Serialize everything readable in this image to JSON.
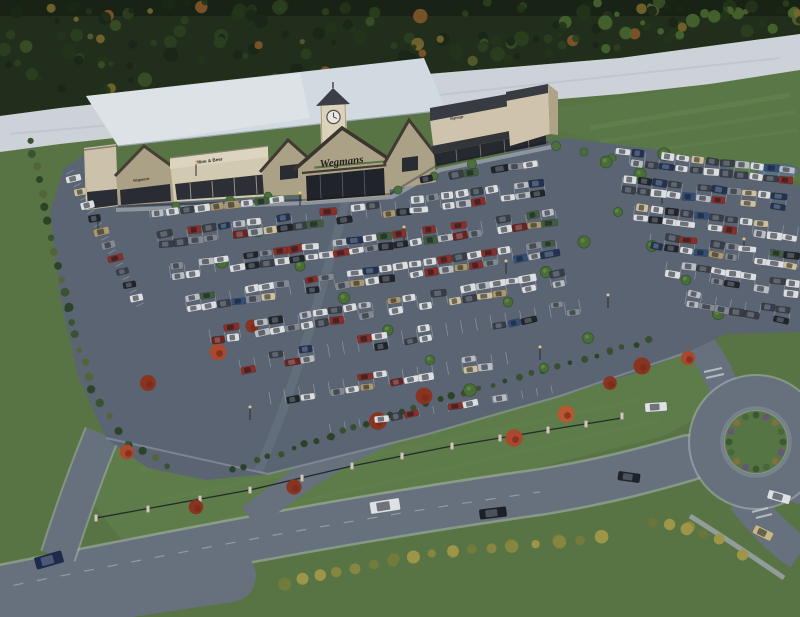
{
  "scene": {
    "description": "Aerial dusk rendering of a Wegmans supermarket with clock tower, large parking lot full of cars, landscaped entrance drive and roundabout",
    "width": 800,
    "height": 617
  },
  "signs": {
    "main": "Wegmans",
    "left_gable": "Wegmans",
    "wine_beer": "Wine & Beer",
    "right_wing": "Signage"
  },
  "palette": {
    "grass": "#5c7946",
    "lawn": "#63814b",
    "forest": "#232f1b",
    "strip": "#d6dce1",
    "field": "#5e7d48",
    "asphalt": "#5f6876",
    "road": "#6c7582",
    "stone": "#b4a88c",
    "cream": "#dacdb2",
    "roof": "#dde4ea",
    "pond": "#5e7886",
    "dark_storefront": "#272a2f",
    "sign_band_dark": "#3a3d42"
  },
  "forest": {
    "count": 170,
    "seed": 11,
    "colors": [
      [
        "#1b2817",
        28
      ],
      [
        "#233519",
        24
      ],
      [
        "#2d431f",
        20
      ],
      [
        "#3c5226",
        10
      ],
      [
        "#5c6030",
        8
      ],
      [
        "#7c6a2e",
        5
      ],
      [
        "#8a5a28",
        5
      ]
    ]
  },
  "parking": {
    "seed": 7,
    "spacing": 15,
    "car_w": 13,
    "car_h": 6.6,
    "car_colors": [
      [
        "#e7e9eb",
        30
      ],
      [
        "#c2c6cc",
        14
      ],
      [
        "#8a8f97",
        10
      ],
      [
        "#3a3f47",
        16
      ],
      [
        "#22252a",
        8
      ],
      [
        "#8e3027",
        6
      ],
      [
        "#6e241f",
        3
      ],
      [
        "#35517c",
        5
      ],
      [
        "#243352",
        4
      ],
      [
        "#b3a071",
        5
      ],
      [
        "#44603f",
        3
      ],
      [
        "#d8c9a3",
        3
      ]
    ],
    "rows": [
      {
        "x1": 150,
        "y1": 214,
        "x2": 292,
        "y2": 198,
        "fill": 0.9,
        "double": false
      },
      {
        "x1": 404,
        "y1": 182,
        "x2": 548,
        "y2": 162,
        "fill": 0.85,
        "double": false
      },
      {
        "x1": 158,
        "y1": 240,
        "x2": 556,
        "y2": 186,
        "fill": 0.8,
        "double": true
      },
      {
        "x1": 170,
        "y1": 272,
        "x2": 562,
        "y2": 216,
        "fill": 0.8,
        "double": true
      },
      {
        "x1": 186,
        "y1": 304,
        "x2": 568,
        "y2": 246,
        "fill": 0.75,
        "double": true
      },
      {
        "x1": 210,
        "y1": 336,
        "x2": 575,
        "y2": 276,
        "fill": 0.65,
        "double": true
      },
      {
        "x1": 240,
        "y1": 366,
        "x2": 580,
        "y2": 306,
        "fill": 0.35,
        "double": true
      },
      {
        "x1": 270,
        "y1": 398,
        "x2": 520,
        "y2": 356,
        "fill": 0.3,
        "double": true
      },
      {
        "x1": 330,
        "y1": 428,
        "x2": 560,
        "y2": 388,
        "fill": 0.28,
        "double": false
      },
      {
        "x1": 615,
        "y1": 156,
        "x2": 796,
        "y2": 176,
        "fill": 0.8,
        "double": true
      },
      {
        "x1": 622,
        "y1": 184,
        "x2": 800,
        "y2": 204,
        "fill": 0.78,
        "double": true
      },
      {
        "x1": 634,
        "y1": 212,
        "x2": 800,
        "y2": 234,
        "fill": 0.75,
        "double": true
      },
      {
        "x1": 650,
        "y1": 240,
        "x2": 800,
        "y2": 262,
        "fill": 0.7,
        "double": true
      },
      {
        "x1": 666,
        "y1": 268,
        "x2": 800,
        "y2": 290,
        "fill": 0.6,
        "double": true
      },
      {
        "x1": 686,
        "y1": 298,
        "x2": 800,
        "y2": 318,
        "fill": 0.5,
        "double": true
      },
      {
        "x1": 70,
        "y1": 172,
        "x2": 146,
        "y2": 316,
        "fill": 0.9,
        "double": false,
        "rot": -12
      }
    ]
  },
  "moving_vehicles": [
    {
      "name": "white-suv",
      "x": 385,
      "y": 506,
      "rot": -9,
      "w": 30,
      "h": 12,
      "color": "#e9ebee"
    },
    {
      "name": "black-sedan",
      "x": 493,
      "y": 513,
      "rot": -7,
      "w": 27,
      "h": 10,
      "color": "#1e2126"
    },
    {
      "name": "navy-car",
      "x": 49,
      "y": 560,
      "rot": -16,
      "w": 28,
      "h": 12,
      "color": "#1f2c50"
    },
    {
      "name": "white-car-roundabout",
      "x": 656,
      "y": 407,
      "rot": -4,
      "w": 22,
      "h": 9,
      "color": "#e9ebee"
    },
    {
      "name": "black-car-west-exit",
      "x": 629,
      "y": 477,
      "rot": 8,
      "w": 22,
      "h": 9,
      "color": "#202329"
    },
    {
      "name": "white-car-east-exit",
      "x": 779,
      "y": 497,
      "rot": 16,
      "w": 23,
      "h": 9,
      "color": "#e9ebee"
    },
    {
      "name": "tan-car-south-exit",
      "x": 763,
      "y": 533,
      "rot": 26,
      "w": 20,
      "h": 9,
      "color": "#cfc089"
    }
  ],
  "trees": {
    "maples": [
      [
        148,
        383
      ],
      [
        127,
        452
      ],
      [
        196,
        507
      ],
      [
        294,
        487
      ],
      [
        378,
        421
      ],
      [
        424,
        396
      ],
      [
        514,
        438
      ],
      [
        566,
        414
      ],
      [
        610,
        383
      ],
      [
        252,
        326
      ],
      [
        218,
        352
      ],
      [
        642,
        366
      ],
      [
        688,
        358
      ]
    ],
    "maple_colors": [
      "#b14a2c",
      "#8f3520",
      "#c25a33"
    ],
    "islands": [
      [
        222,
        262
      ],
      [
        258,
        232
      ],
      [
        300,
        266
      ],
      [
        344,
        298
      ],
      [
        388,
        330
      ],
      [
        430,
        360
      ],
      [
        470,
        390
      ],
      [
        508,
        302
      ],
      [
        546,
        272
      ],
      [
        584,
        242
      ],
      [
        618,
        212
      ],
      [
        652,
        246
      ],
      [
        686,
        280
      ],
      [
        718,
        314
      ],
      [
        588,
        338
      ],
      [
        544,
        368
      ],
      [
        606,
        162
      ],
      [
        640,
        174
      ],
      [
        664,
        154
      ]
    ],
    "island_color": "#4d7038",
    "facade": [
      [
        176,
        206
      ],
      [
        230,
        200
      ],
      [
        268,
        196
      ],
      [
        398,
        190
      ],
      [
        434,
        176
      ],
      [
        472,
        164
      ],
      [
        556,
        146
      ],
      [
        584,
        152
      ],
      [
        612,
        158
      ]
    ],
    "facade_color": "#4f7340"
  },
  "hedges": [
    {
      "name": "left-hedge",
      "pts": [
        [
          30,
          140
        ],
        [
          48,
          222
        ],
        [
          68,
          308
        ],
        [
          92,
          390
        ],
        [
          128,
          444
        ],
        [
          168,
          466
        ]
      ],
      "spacing": 13,
      "r": 3.6,
      "colors": [
        "#2f4527",
        "#3c5530",
        "#57683a"
      ]
    },
    {
      "name": "lot-front-hedge",
      "pts": [
        [
          232,
          470
        ],
        [
          330,
          436
        ],
        [
          426,
          404
        ],
        [
          518,
          378
        ],
        [
          610,
          352
        ],
        [
          648,
          340
        ]
      ],
      "spacing": 12,
      "r": 3,
      "colors": [
        "#2f4527",
        "#3a5230"
      ]
    },
    {
      "name": "bottom-shrubs",
      "pts": [
        [
          286,
          584
        ],
        [
          336,
          572
        ],
        [
          394,
          560
        ],
        [
          452,
          552
        ],
        [
          512,
          546
        ],
        [
          560,
          542
        ],
        [
          602,
          538
        ]
      ],
      "spacing": 17,
      "r": 5.5,
      "colors": [
        "#8d8c42",
        "#a59b48",
        "#77803c"
      ]
    },
    {
      "name": "roundabout-se-shrubs",
      "pts": [
        [
          652,
          522
        ],
        [
          688,
          528
        ],
        [
          718,
          540
        ],
        [
          744,
          554
        ]
      ],
      "spacing": 15,
      "r": 5,
      "colors": [
        "#8d8c42",
        "#6f7a3a",
        "#a59b48"
      ]
    }
  ],
  "fence": {
    "pillars": [
      [
        96,
        520
      ],
      [
        148,
        511
      ],
      [
        200,
        501
      ],
      [
        250,
        492
      ],
      [
        302,
        480
      ],
      [
        352,
        468
      ],
      [
        402,
        458
      ],
      [
        452,
        448
      ],
      [
        500,
        440
      ],
      [
        548,
        432
      ],
      [
        586,
        426
      ],
      [
        622,
        418
      ]
    ]
  },
  "light_poles": [
    [
      98,
      232
    ],
    [
      196,
      176
    ],
    [
      300,
      206
    ],
    [
      404,
      240
    ],
    [
      506,
      274
    ],
    [
      608,
      308
    ],
    [
      662,
      204
    ],
    [
      744,
      252
    ],
    [
      250,
      420
    ],
    [
      540,
      360
    ]
  ],
  "roundabout": {
    "cx": 756,
    "cy": 442,
    "island_r": 31,
    "shrub_count": 16,
    "shrub_colors": [
      "#3f5a33",
      "#6b5878",
      "#8a7440",
      "#4d6b3b"
    ]
  }
}
